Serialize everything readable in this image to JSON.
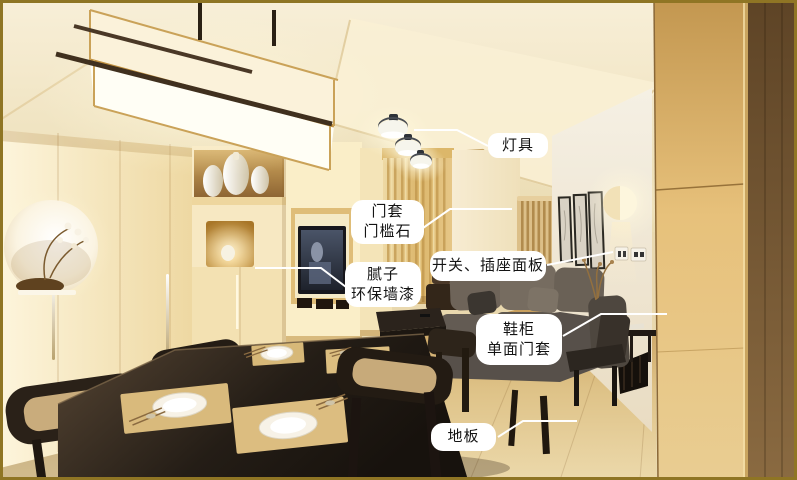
{
  "scene": {
    "type": "annotated-interior-photo",
    "subject": "Japanese-style living and dining room with renovation feature callouts",
    "border_color": "#8f7524",
    "callout_bg": "#ffffff",
    "callout_text_color": "#141414",
    "leader_line_color": "#ffffff"
  },
  "annotations": {
    "lighting": {
      "lines": [
        "灯具"
      ]
    },
    "door_frame": {
      "lines": [
        "门套",
        "门槛石"
      ]
    },
    "switch_socket": {
      "lines": [
        "开关、插座面板"
      ]
    },
    "wall_paint": {
      "lines": [
        "腻子",
        "环保墙漆"
      ]
    },
    "shoe_cabinet": {
      "lines": [
        "鞋柜",
        "单面门套"
      ]
    },
    "floor": {
      "lines": [
        "地板"
      ]
    }
  }
}
